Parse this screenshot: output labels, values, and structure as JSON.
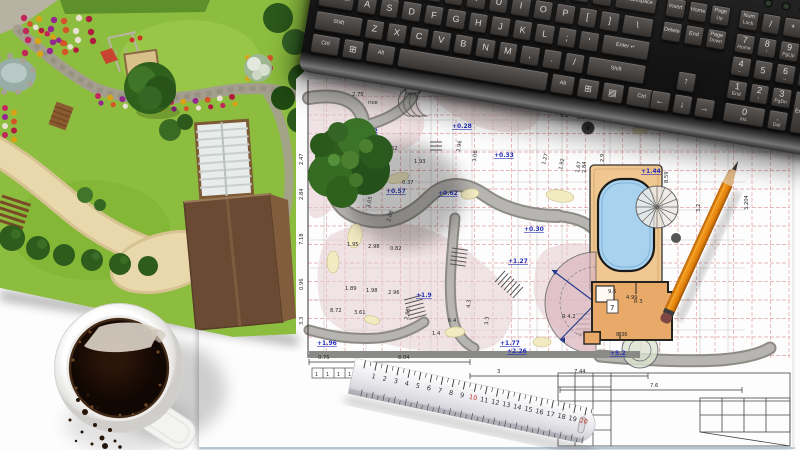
{
  "colors": {
    "desk": "#fdfdfd",
    "keyboard_body": "#1a1a1a",
    "keycap": "#4a4644",
    "key_text": "#d8d5d2",
    "lawn": "#8cbd3e",
    "tree_dark": "#2f5d1d",
    "path_tan": "#e9d8ab",
    "stone_gray": "#a39e8e",
    "flower_red": "#c2275c",
    "flower_yellow": "#d9a316",
    "flower_purple": "#93268f",
    "plan_grid_red": "#d98c8c",
    "plan_pink": "#e6cdd1",
    "plan_yellow": "#f2ebc2",
    "plan_path_gray": "#b5b3af",
    "pool_blue": "#a9d2ef",
    "deck_tan": "#f1c791",
    "building_orange": "#e9a968",
    "elevation_blue": "#2531b8",
    "dim_black": "#2a2a2a",
    "pencil_orange": "#e8870f",
    "eraser_red": "#7e4743",
    "ruler_body": "#f2f2f4",
    "ruler_red": "#c03028",
    "coffee": "#180c05",
    "mug_white": "#f4f4f2"
  },
  "keyboard": {
    "pitch": 22.5,
    "key_h": 20,
    "tall_h": 43.5,
    "sections": [
      {
        "x": 8,
        "rows": [
          {
            "y": 6,
            "keys": [
              {
                "t": "`"
              },
              {
                "t": "1"
              },
              {
                "t": "2"
              },
              {
                "t": "3"
              },
              {
                "t": "4"
              },
              {
                "t": "5"
              },
              {
                "t": "6"
              },
              {
                "t": "7"
              },
              {
                "t": "8"
              },
              {
                "t": "9"
              },
              {
                "t": "0"
              },
              {
                "t": "-"
              },
              {
                "t": "="
              },
              {
                "t": "← Backspace",
                "w": 2,
                "small": 1
              }
            ]
          },
          {
            "y": 29.5,
            "keys": [
              {
                "t": "Tab",
                "w": 1.5,
                "small": 1
              },
              {
                "t": "Q"
              },
              {
                "t": "W"
              },
              {
                "t": "E"
              },
              {
                "t": "R"
              },
              {
                "t": "T"
              },
              {
                "t": "Y"
              },
              {
                "t": "U"
              },
              {
                "t": "I"
              },
              {
                "t": "O"
              },
              {
                "t": "P"
              },
              {
                "t": "["
              },
              {
                "t": "]"
              },
              {
                "t": "\\",
                "w": 1.5
              }
            ]
          },
          {
            "y": 53,
            "keys": [
              {
                "t": "Caps Lock",
                "w": 1.75,
                "small": 1
              },
              {
                "t": "A"
              },
              {
                "t": "S"
              },
              {
                "t": "D"
              },
              {
                "t": "F"
              },
              {
                "t": "G"
              },
              {
                "t": "H"
              },
              {
                "t": "J"
              },
              {
                "t": "K"
              },
              {
                "t": "L"
              },
              {
                "t": ";"
              },
              {
                "t": "'"
              },
              {
                "t": "Enter ↵",
                "w": 2.25,
                "small": 1
              }
            ]
          },
          {
            "y": 76.5,
            "keys": [
              {
                "t": "Shift",
                "w": 2.25,
                "small": 1
              },
              {
                "t": "Z"
              },
              {
                "t": "X"
              },
              {
                "t": "C"
              },
              {
                "t": "V"
              },
              {
                "t": "B"
              },
              {
                "t": "N"
              },
              {
                "t": "M"
              },
              {
                "t": ","
              },
              {
                "t": "."
              },
              {
                "t": "/"
              },
              {
                "t": "Shift",
                "w": 2.75,
                "small": 1
              }
            ]
          },
          {
            "y": 100,
            "keys": [
              {
                "t": "Ctrl",
                "w": 1.4,
                "small": 1
              },
              {
                "t": "⊞",
                "w": 1.1
              },
              {
                "t": "Alt",
                "w": 1.4,
                "small": 1
              },
              {
                "t": "",
                "w": 6.9
              },
              {
                "t": "Alt",
                "w": 1.2,
                "small": 1
              },
              {
                "t": "⊞",
                "w": 1.1
              },
              {
                "t": "▤",
                "w": 1.1
              },
              {
                "t": "Ctrl",
                "w": 1.5,
                "small": 1
              }
            ]
          }
        ]
      },
      {
        "x": 352,
        "rows": [
          {
            "y": 6,
            "keys": [
              {
                "t": "Insert",
                "small": 1
              },
              {
                "t": "Home",
                "small": 1
              },
              {
                "t": "Page",
                "s": "Up",
                "small": 1
              }
            ]
          },
          {
            "y": 29.5,
            "keys": [
              {
                "t": "Delete",
                "small": 1
              },
              {
                "t": "End",
                "small": 1
              },
              {
                "t": "Page",
                "s": "Down",
                "small": 1
              }
            ]
          },
          {
            "y": 76.5,
            "keys": [
              {
                "sp": 1
              },
              {
                "t": "↑"
              }
            ]
          },
          {
            "y": 100,
            "keys": [
              {
                "t": "←"
              },
              {
                "t": "↓"
              },
              {
                "t": "→"
              }
            ]
          }
        ]
      },
      {
        "x": 426,
        "rows": [
          {
            "y": 6,
            "keys": [
              {
                "t": "Num",
                "s": "Lock",
                "small": 1
              },
              {
                "t": "/"
              },
              {
                "t": "*"
              },
              {
                "t": "-"
              }
            ]
          },
          {
            "y": 29.5,
            "keys": [
              {
                "t": "7",
                "s": "Home"
              },
              {
                "t": "8",
                "s": "↑"
              },
              {
                "t": "9",
                "s": "PgUp"
              },
              {
                "t": "+",
                "h": 2
              }
            ]
          },
          {
            "y": 53,
            "keys": [
              {
                "t": "4",
                "s": "←"
              },
              {
                "t": "5"
              },
              {
                "t": "6",
                "s": "→"
              }
            ]
          },
          {
            "y": 76.5,
            "keys": [
              {
                "t": "1",
                "s": "End"
              },
              {
                "t": "2",
                "s": "↓"
              },
              {
                "t": "3",
                "s": "PgDn"
              },
              {
                "t": "Enter",
                "small": 1,
                "h": 2
              }
            ]
          },
          {
            "y": 100,
            "keys": [
              {
                "t": "0",
                "s": "Ins",
                "w": 2
              },
              {
                "t": ".",
                "s": "Del"
              }
            ]
          }
        ]
      }
    ]
  },
  "blueprint": {
    "elevation_labels": [
      {
        "x": 358,
        "y": 133,
        "t": "+0.02"
      },
      {
        "x": 452,
        "y": 128,
        "t": "+0.28"
      },
      {
        "x": 494,
        "y": 157,
        "t": "+0.33"
      },
      {
        "x": 438,
        "y": 195,
        "t": "+0.62"
      },
      {
        "x": 386,
        "y": 193,
        "t": "+0.57"
      },
      {
        "x": 524,
        "y": 231,
        "t": "+0.30"
      },
      {
        "x": 641,
        "y": 173,
        "t": "+1.44"
      },
      {
        "x": 508,
        "y": 263,
        "t": "+1.27"
      },
      {
        "x": 416,
        "y": 297,
        "t": "+1.9"
      },
      {
        "x": 500,
        "y": 345,
        "t": "+1.77"
      },
      {
        "x": 507,
        "y": 353,
        "t": "+2.26"
      },
      {
        "x": 610,
        "y": 355,
        "t": "+5.2"
      },
      {
        "x": 317,
        "y": 345,
        "t": "+1.96"
      }
    ],
    "dimension_labels": [
      {
        "x": 318,
        "y": 359,
        "t": "0.75"
      },
      {
        "x": 398,
        "y": 359,
        "t": "8.04"
      },
      {
        "x": 497,
        "y": 373,
        "t": "3"
      },
      {
        "x": 574,
        "y": 373,
        "t": "7.44"
      },
      {
        "x": 650,
        "y": 387,
        "t": "7.6"
      },
      {
        "x": 352,
        "y": 96,
        "t": "2.75"
      },
      {
        "x": 386,
        "y": 150,
        "t": "1.62"
      },
      {
        "x": 414,
        "y": 163,
        "t": "1.93"
      },
      {
        "x": 402,
        "y": 184,
        "t": "0.37"
      },
      {
        "x": 560,
        "y": 117,
        "t": "5.8"
      },
      {
        "x": 577,
        "y": 119,
        "t": "3.8"
      },
      {
        "x": 599,
        "y": 121,
        "t": "0.77"
      },
      {
        "x": 347,
        "y": 246,
        "t": "1.95"
      },
      {
        "x": 368,
        "y": 248,
        "t": "2.98"
      },
      {
        "x": 390,
        "y": 250,
        "t": "0.82"
      },
      {
        "x": 345,
        "y": 290,
        "t": "1.89"
      },
      {
        "x": 366,
        "y": 292,
        "t": "1.98"
      },
      {
        "x": 388,
        "y": 294,
        "t": "2.96"
      },
      {
        "x": 330,
        "y": 312,
        "t": "8.72"
      },
      {
        "x": 354,
        "y": 314,
        "t": "3.61"
      },
      {
        "x": 432,
        "y": 335,
        "t": "1.4"
      },
      {
        "x": 448,
        "y": 322,
        "t": "6.4"
      },
      {
        "x": 626,
        "y": 299,
        "t": "4.99"
      },
      {
        "x": 608,
        "y": 293,
        "t": "9.6"
      },
      {
        "x": 616,
        "y": 336,
        "t": "8.36"
      },
      {
        "x": 562,
        "y": 318,
        "t": "R 4.2"
      },
      {
        "x": 634,
        "y": 303,
        "t": "R 3"
      },
      {
        "x": 412,
        "y": 90,
        "t": "50"
      },
      {
        "x": 368,
        "y": 104,
        "t": "rice"
      },
      {
        "x": 303,
        "y": 165,
        "t": "2.47",
        "r": -90
      },
      {
        "x": 303,
        "y": 200,
        "t": "2.84",
        "r": -90
      },
      {
        "x": 303,
        "y": 245,
        "t": "7.18",
        "r": -90
      },
      {
        "x": 303,
        "y": 290,
        "t": "0.96",
        "r": -90
      },
      {
        "x": 303,
        "y": 325,
        "t": "3.3",
        "r": -90
      },
      {
        "x": 545,
        "y": 165,
        "t": "1.27",
        "r": -75
      },
      {
        "x": 562,
        "y": 170,
        "t": "1.92",
        "r": -78
      },
      {
        "x": 579,
        "y": 173,
        "t": "1.67",
        "r": -80
      },
      {
        "x": 460,
        "y": 152,
        "t": "2.96",
        "r": -82
      },
      {
        "x": 476,
        "y": 162,
        "t": "3.06",
        "r": -85
      },
      {
        "x": 604,
        "y": 162,
        "t": "2.9",
        "r": -90
      },
      {
        "x": 586,
        "y": 173,
        "t": "2.84",
        "r": -90
      },
      {
        "x": 668,
        "y": 183,
        "t": "8.59",
        "r": -90
      },
      {
        "x": 700,
        "y": 212,
        "t": "3.2",
        "r": -90
      },
      {
        "x": 748,
        "y": 210,
        "t": "3.204",
        "r": -90
      },
      {
        "x": 408,
        "y": 320,
        "t": "2.88",
        "r": -80
      },
      {
        "x": 470,
        "y": 308,
        "t": "4.3",
        "r": -85
      },
      {
        "x": 488,
        "y": 325,
        "t": "3.3",
        "r": -85
      },
      {
        "x": 370,
        "y": 208,
        "t": "3.05",
        "r": -80
      },
      {
        "x": 390,
        "y": 222,
        "t": "2.06",
        "r": -75
      }
    ],
    "room_label": "7",
    "tick_row": [
      "1",
      "1",
      "1",
      "1"
    ]
  },
  "ruler": {
    "numbers": [
      1,
      2,
      3,
      4,
      5,
      6,
      7,
      8,
      9,
      10,
      11,
      12,
      13,
      14,
      15,
      16,
      17,
      18,
      19,
      20
    ],
    "red": [
      10,
      20
    ]
  }
}
